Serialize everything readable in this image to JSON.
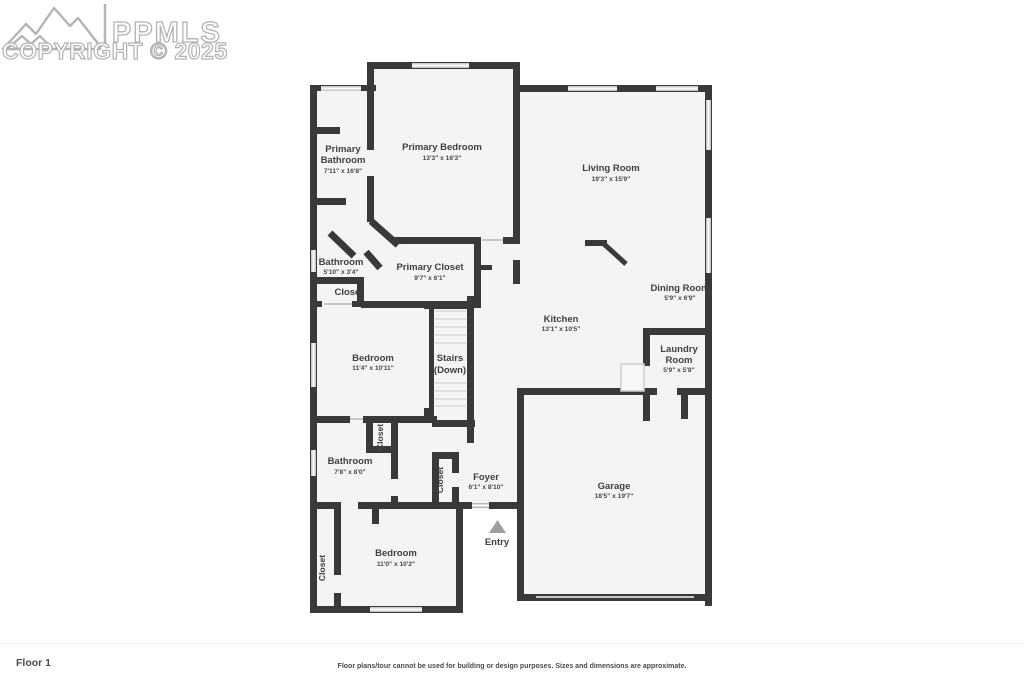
{
  "logo": {
    "brand": "PPMLS",
    "copyright": "COPYRIGHT © 2025"
  },
  "footer": {
    "floor_label": "Floor 1",
    "disclaimer": "Floor plans/tour cannot be used for building or design purposes. Sizes and dimensions are approximate."
  },
  "colors": {
    "wall": "#39393b",
    "room_fill": "#f4f4f4",
    "window": "#c9c9c9",
    "label_text": "#3f3f41",
    "logo_outline": "#b2b2b2",
    "entry_marker": "#9e9e9e"
  },
  "rooms": [
    {
      "id": "primary-bathroom",
      "lines": [
        "Primary",
        "Bathroom"
      ],
      "dims": "7'11\" x 16'8\""
    },
    {
      "id": "primary-bedroom",
      "lines": [
        "Primary Bedroom"
      ],
      "dims": "13'3\" x 16'3\""
    },
    {
      "id": "living-room",
      "lines": [
        "Living Room"
      ],
      "dims": "19'3\" x 15'9\""
    },
    {
      "id": "bathroom-small",
      "lines": [
        "Bathroom"
      ],
      "dims": "5'10\" x 3'4\""
    },
    {
      "id": "primary-closet",
      "lines": [
        "Primary Closet"
      ],
      "dims": "9'7\" x 6'1\""
    },
    {
      "id": "closet-hall",
      "lines": [
        "Closet"
      ],
      "dims": ""
    },
    {
      "id": "dining-room",
      "lines": [
        "Dining Room"
      ],
      "dims": "5'9\" x 6'9\""
    },
    {
      "id": "kitchen",
      "lines": [
        "Kitchen"
      ],
      "dims": "13'1\" x 10'5\""
    },
    {
      "id": "laundry-room",
      "lines": [
        "Laundry",
        "Room"
      ],
      "dims": "5'9\" x 5'8\""
    },
    {
      "id": "bedroom-middle",
      "lines": [
        "Bedroom"
      ],
      "dims": "11'4\" x 10'11\""
    },
    {
      "id": "stairs",
      "lines": [
        "Stairs",
        "(Down)"
      ],
      "dims": ""
    },
    {
      "id": "closet-mid",
      "lines": [
        "Closet"
      ],
      "dims": ""
    },
    {
      "id": "bathroom",
      "lines": [
        "Bathroom"
      ],
      "dims": "7'8\" x 8'0\""
    },
    {
      "id": "closet-foyer",
      "lines": [
        "Closet"
      ],
      "dims": ""
    },
    {
      "id": "foyer",
      "lines": [
        "Foyer"
      ],
      "dims": "6'1\" x 8'10\""
    },
    {
      "id": "garage",
      "lines": [
        "Garage"
      ],
      "dims": "18'5\" x 19'7\""
    },
    {
      "id": "entry",
      "lines": [
        "Entry"
      ],
      "dims": ""
    },
    {
      "id": "bedroom-bottom",
      "lines": [
        "Bedroom"
      ],
      "dims": "11'0\" x 10'2\""
    },
    {
      "id": "closet-bottom",
      "lines": [
        "Closet"
      ],
      "dims": ""
    }
  ]
}
